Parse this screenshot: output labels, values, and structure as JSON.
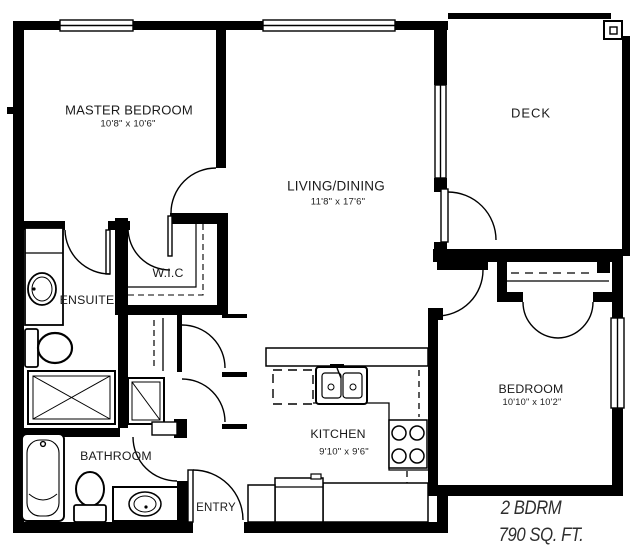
{
  "rooms": [
    {
      "id": "master_bedroom",
      "label": "MASTER BEDROOM",
      "dims": "10'8\" x 10'6\""
    },
    {
      "id": "living_dining",
      "label": "LIVING/DINING",
      "dims": "11'8\" x 17'6\""
    },
    {
      "id": "deck",
      "label": "DECK",
      "dims": ""
    },
    {
      "id": "wic",
      "label": "W.I.C",
      "dims": ""
    },
    {
      "id": "ensuite",
      "label": "ENSUITE",
      "dims": ""
    },
    {
      "id": "bathroom",
      "label": "BATHROOM",
      "dims": ""
    },
    {
      "id": "entry",
      "label": "ENTRY",
      "dims": ""
    },
    {
      "id": "kitchen",
      "label": "KITCHEN",
      "dims": "9'10\" x 9'6\""
    },
    {
      "id": "bedroom",
      "label": "BEDROOM",
      "dims": "10'10\" x 10'2\""
    }
  ],
  "summary": {
    "unit_type": "2 BDRM",
    "area": "790 SQ. FT."
  },
  "fixtures": [
    "bathtub",
    "toilet",
    "shower",
    "vanity-sink",
    "linen-closet",
    "kitchen-sink",
    "stove",
    "refrigerator",
    "closet-rod",
    "deck-post",
    "window",
    "door-swing"
  ],
  "colors": {
    "wall": "#000000",
    "background": "#ffffff",
    "text": "#1a1a1a"
  }
}
